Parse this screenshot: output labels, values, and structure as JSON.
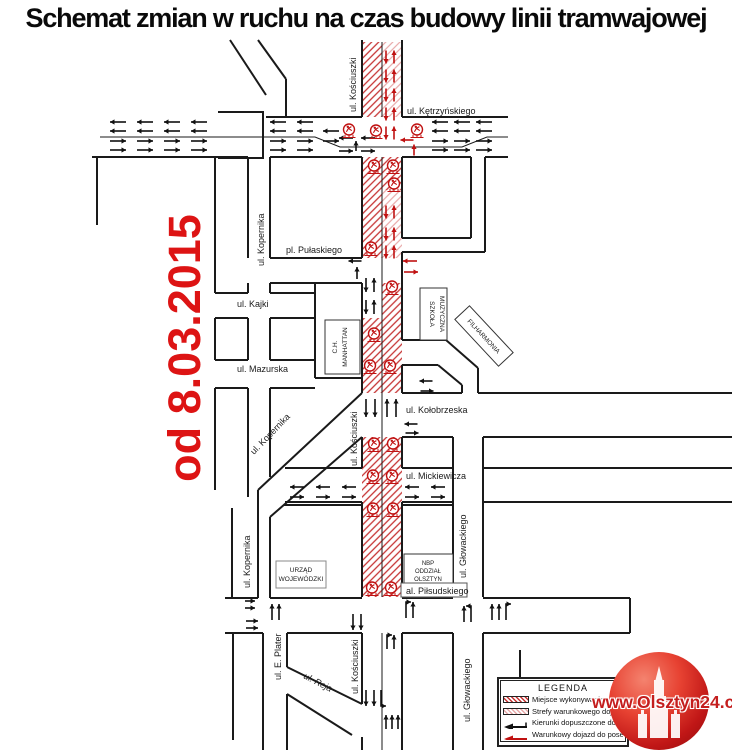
{
  "title": "Schemat zmian w ruchu na czas budowy linii tramwajowej",
  "date_label": "od 8.03.2015",
  "map": {
    "streets": {
      "kosciuszki_top": "ul. Kościuszki",
      "kosciuszki_mid": "ul. Kościuszki",
      "kosciuszki_bottom": "ul. Kościuszki",
      "ketrzynskiego": "ul. Kętrzyńskiego",
      "kopernika_top": "ul. Kopernika",
      "kopernika_diag": "ul. Kopernika",
      "kopernika_bottom": "ul. Kopernika",
      "pulaskiego": "pl. Pułaskiego",
      "kajki": "ul. Kajki",
      "mazurska": "ul. Mazurska",
      "kolobrzeska": "ul. Kołobrzeska",
      "mickiewicza": "ul. Mickiewicza",
      "pilsudskiego": "al. Piłsudskiego",
      "eplater": "ul. E. Plater",
      "reja": "ul. Reja",
      "glowackiego_mid": "ul. Głowackiego",
      "glowackiego_bottom": "ul. Głowackiego"
    },
    "buildings": {
      "manhattan_line1": "C.H.",
      "manhattan_line2": "MANHATTAN",
      "szkola_line1": "SZKOŁA",
      "szkola_line2": "MUZYCZNA",
      "filharmonia": "FILHARMONIA",
      "urzad_line1": "URZĄD",
      "urzad_line2": "WOJEWÓDZKI",
      "nbp_line1": "NBP",
      "nbp_line2": "ODDZIAŁ",
      "nbp_line3": "OLSZTYN"
    }
  },
  "legend": {
    "title": "LEGENDA",
    "items": [
      {
        "swatch": "hatch-dense",
        "label": "Miejsce wykonywania robót"
      },
      {
        "swatch": "hatch-light",
        "label": "Strefy warunkowego dojazdu"
      },
      {
        "swatch": "arrow-black",
        "label": "Kierunki dopuszczone do ruchu"
      },
      {
        "swatch": "arrow-red",
        "label": "Warunkowy dojazd do posesji"
      }
    ]
  },
  "watermark": {
    "text": "www.Olsztyn24.com"
  },
  "icons": {
    "roadworks": "roadworks-icon",
    "castle": "castle-icon"
  },
  "colors": {
    "construction_hatch": "#c63333",
    "conditional_hatch": "#e8a8a8",
    "date_red": "#dd1414",
    "arrow_red": "#c01111",
    "arrow_black": "#111111",
    "logo_red": "#c41e1e"
  }
}
